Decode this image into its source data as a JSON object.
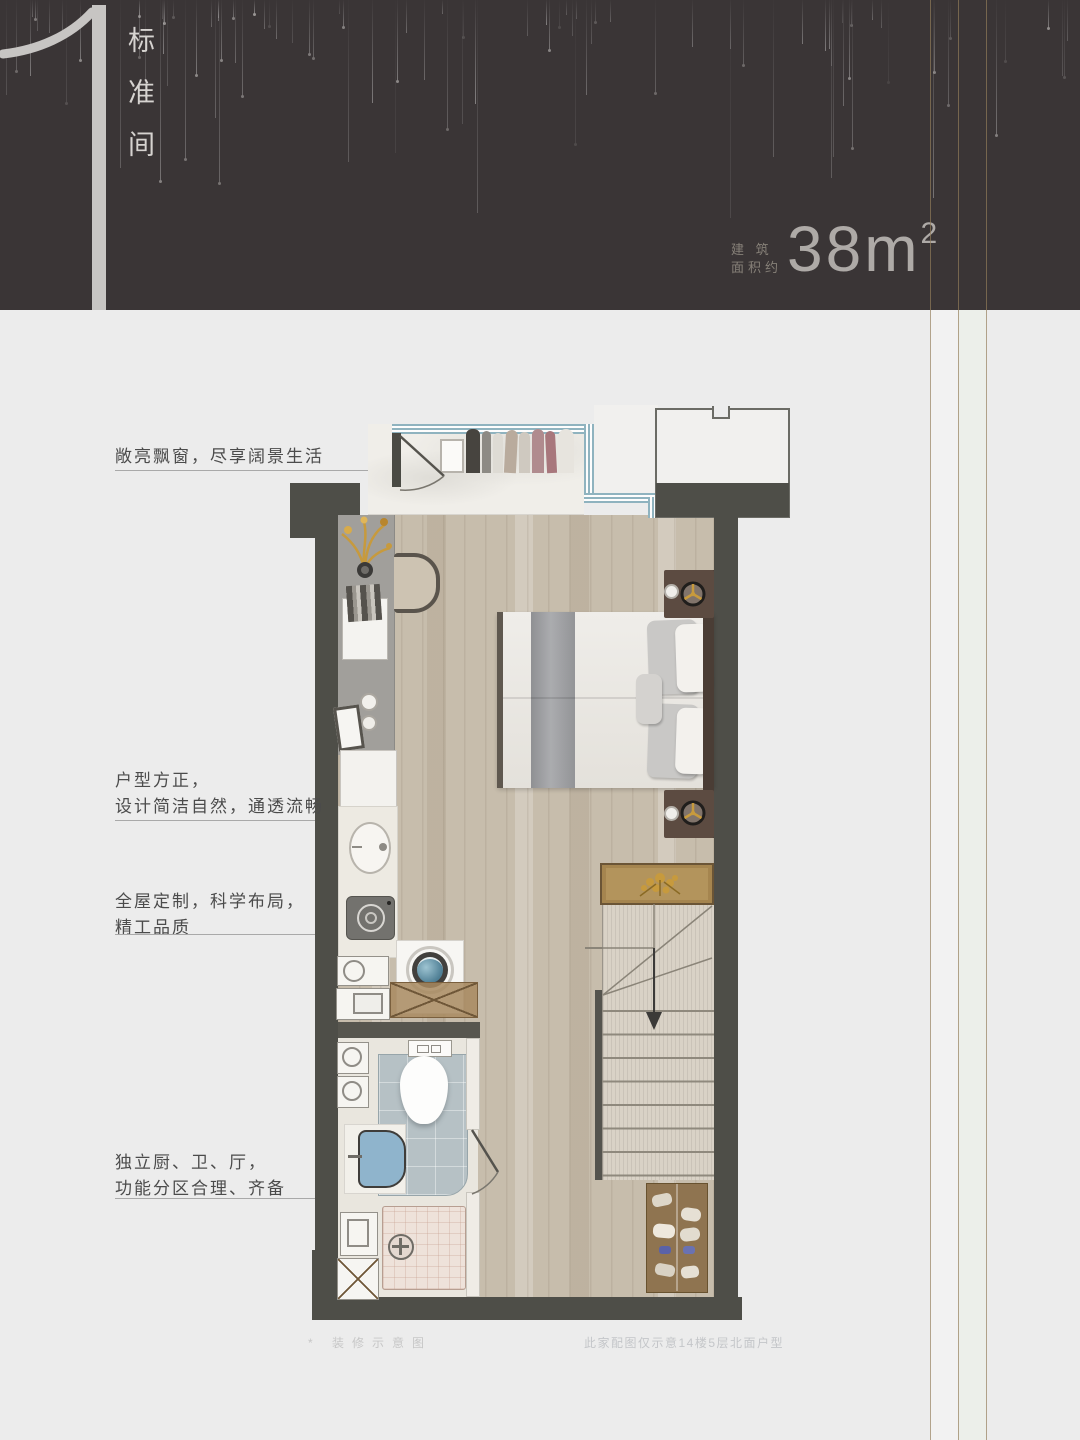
{
  "header": {
    "unit_number": "1",
    "unit_title": "标准间",
    "area_label_top": "建 筑",
    "area_label_bottom": "面积约",
    "area_value": "38",
    "area_unit": "m",
    "area_exponent": "2"
  },
  "annotations": [
    {
      "lines": [
        "敞亮飘窗，尽享阔景生活"
      ]
    },
    {
      "lines": [
        "户型方正，",
        "设计简洁自然，通透流畅"
      ]
    },
    {
      "lines": [
        "全屋定制，科学布局，",
        "精工品质"
      ]
    },
    {
      "lines": [
        "独立厨、卫、厅，",
        "功能分区合理、齐备"
      ]
    }
  ],
  "footnotes": {
    "left": "* 装修示意图",
    "right": "此家配图仅示意14楼5层北面户型"
  },
  "colors": {
    "header_bg": "#3a3536",
    "page_bg": "#ececec",
    "wall": "#4e4e48",
    "wood_floor": "#c7bdac",
    "accent_gold": "#c79a3d",
    "window_blue": "#8fb3bf",
    "bath_tile_blue": "#b6c1c5",
    "numeral_gray": "#c7c5c3"
  }
}
